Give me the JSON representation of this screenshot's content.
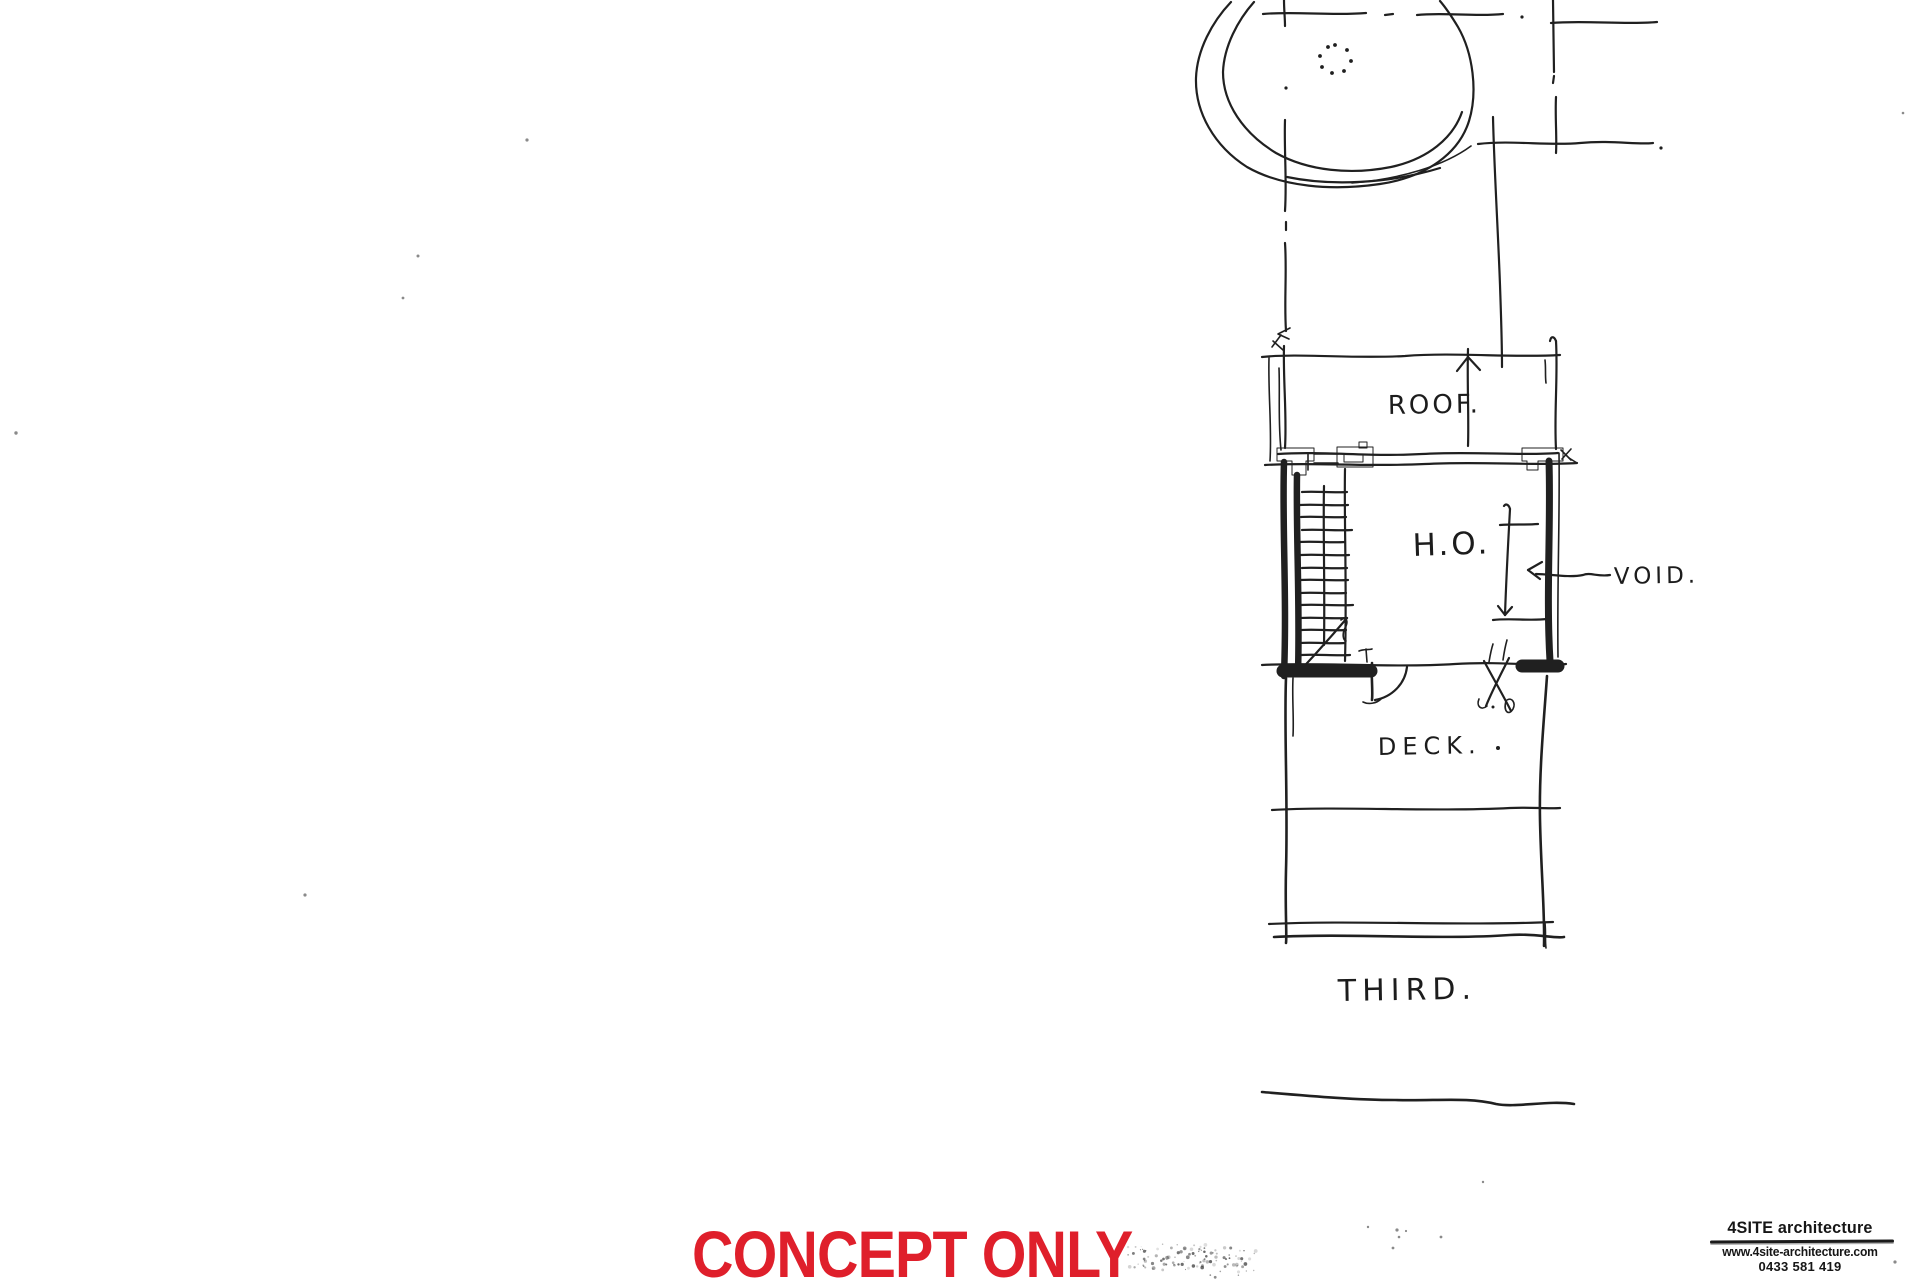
{
  "sheet": {
    "kind": "hand-drawn concept floor plan sketch",
    "paper": "#ffffff",
    "ink": "#202020"
  },
  "plan_labels": {
    "roof": "ROOF.",
    "room": "H.O.",
    "void": "VOID.",
    "deck": "DECK.",
    "level": "THIRD."
  },
  "stamp": {
    "text": "CONCEPT ONLY",
    "color": "#df1f2b"
  },
  "titleblock": {
    "firm": "4SITE architecture",
    "website": "www.4site-architecture.com",
    "phone": "0433 581 419"
  }
}
